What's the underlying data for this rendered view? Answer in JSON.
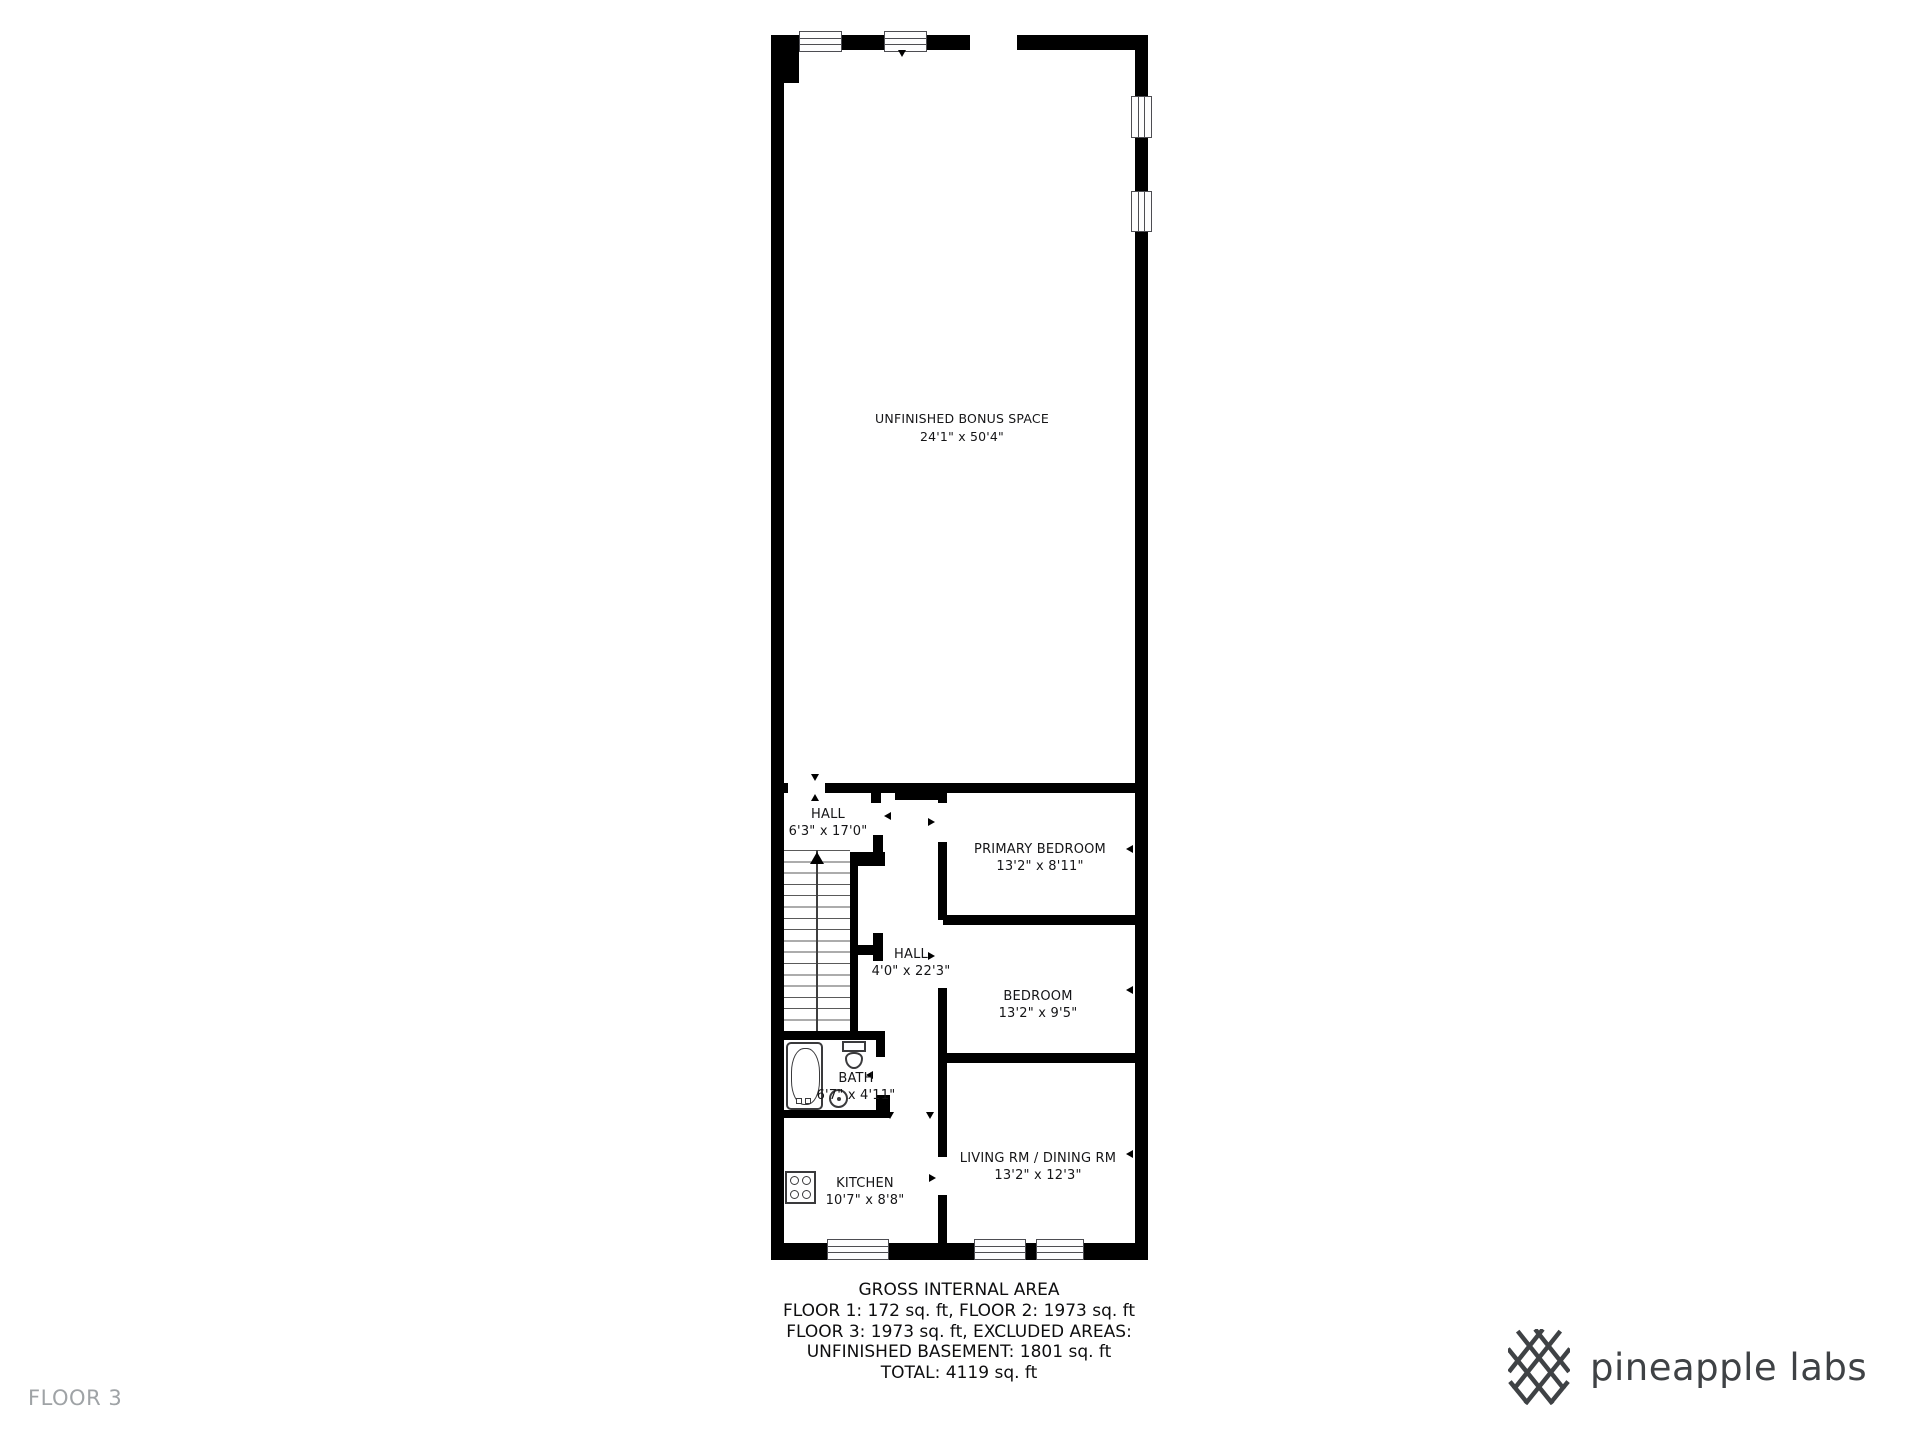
{
  "plan": {
    "bonus_space": {
      "name": "UNFINISHED BONUS SPACE",
      "dims": "24'1\" x 50'4\""
    },
    "rooms": {
      "hall_upper": {
        "name": "HALL",
        "dims": "6'3\" x 17'0\""
      },
      "primary_bedroom": {
        "name": "PRIMARY BEDROOM",
        "dims": "13'2\" x 8'11\""
      },
      "hall_corridor": {
        "name": "HALL",
        "dims": "4'0\" x 22'3\""
      },
      "bedroom": {
        "name": "BEDROOM",
        "dims": "13'2\" x 9'5\""
      },
      "bath": {
        "name": "BATH",
        "dims": "6'7\" x 4'11\""
      },
      "kitchen": {
        "name": "KITCHEN",
        "dims": "10'7\" x 8'8\""
      },
      "living_dining": {
        "name": "LIVING RM / DINING RM",
        "dims": "13'2\" x 12'3\""
      }
    }
  },
  "summary": {
    "title": "GROSS INTERNAL AREA",
    "line1": "FLOOR 1: 172 sq. ft, FLOOR 2: 1973 sq. ft",
    "line2": "FLOOR 3: 1973 sq. ft, EXCLUDED AREAS:",
    "line3": "UNFINISHED BASEMENT: 1801 sq. ft",
    "line4": "TOTAL: 4119 sq. ft"
  },
  "floor_label": "FLOOR 3",
  "brand": {
    "name": "pineapple labs"
  },
  "colors": {
    "wall": "#000000",
    "text": "#151517",
    "muted": "#9fa3a6",
    "brand": "#3f4245"
  }
}
